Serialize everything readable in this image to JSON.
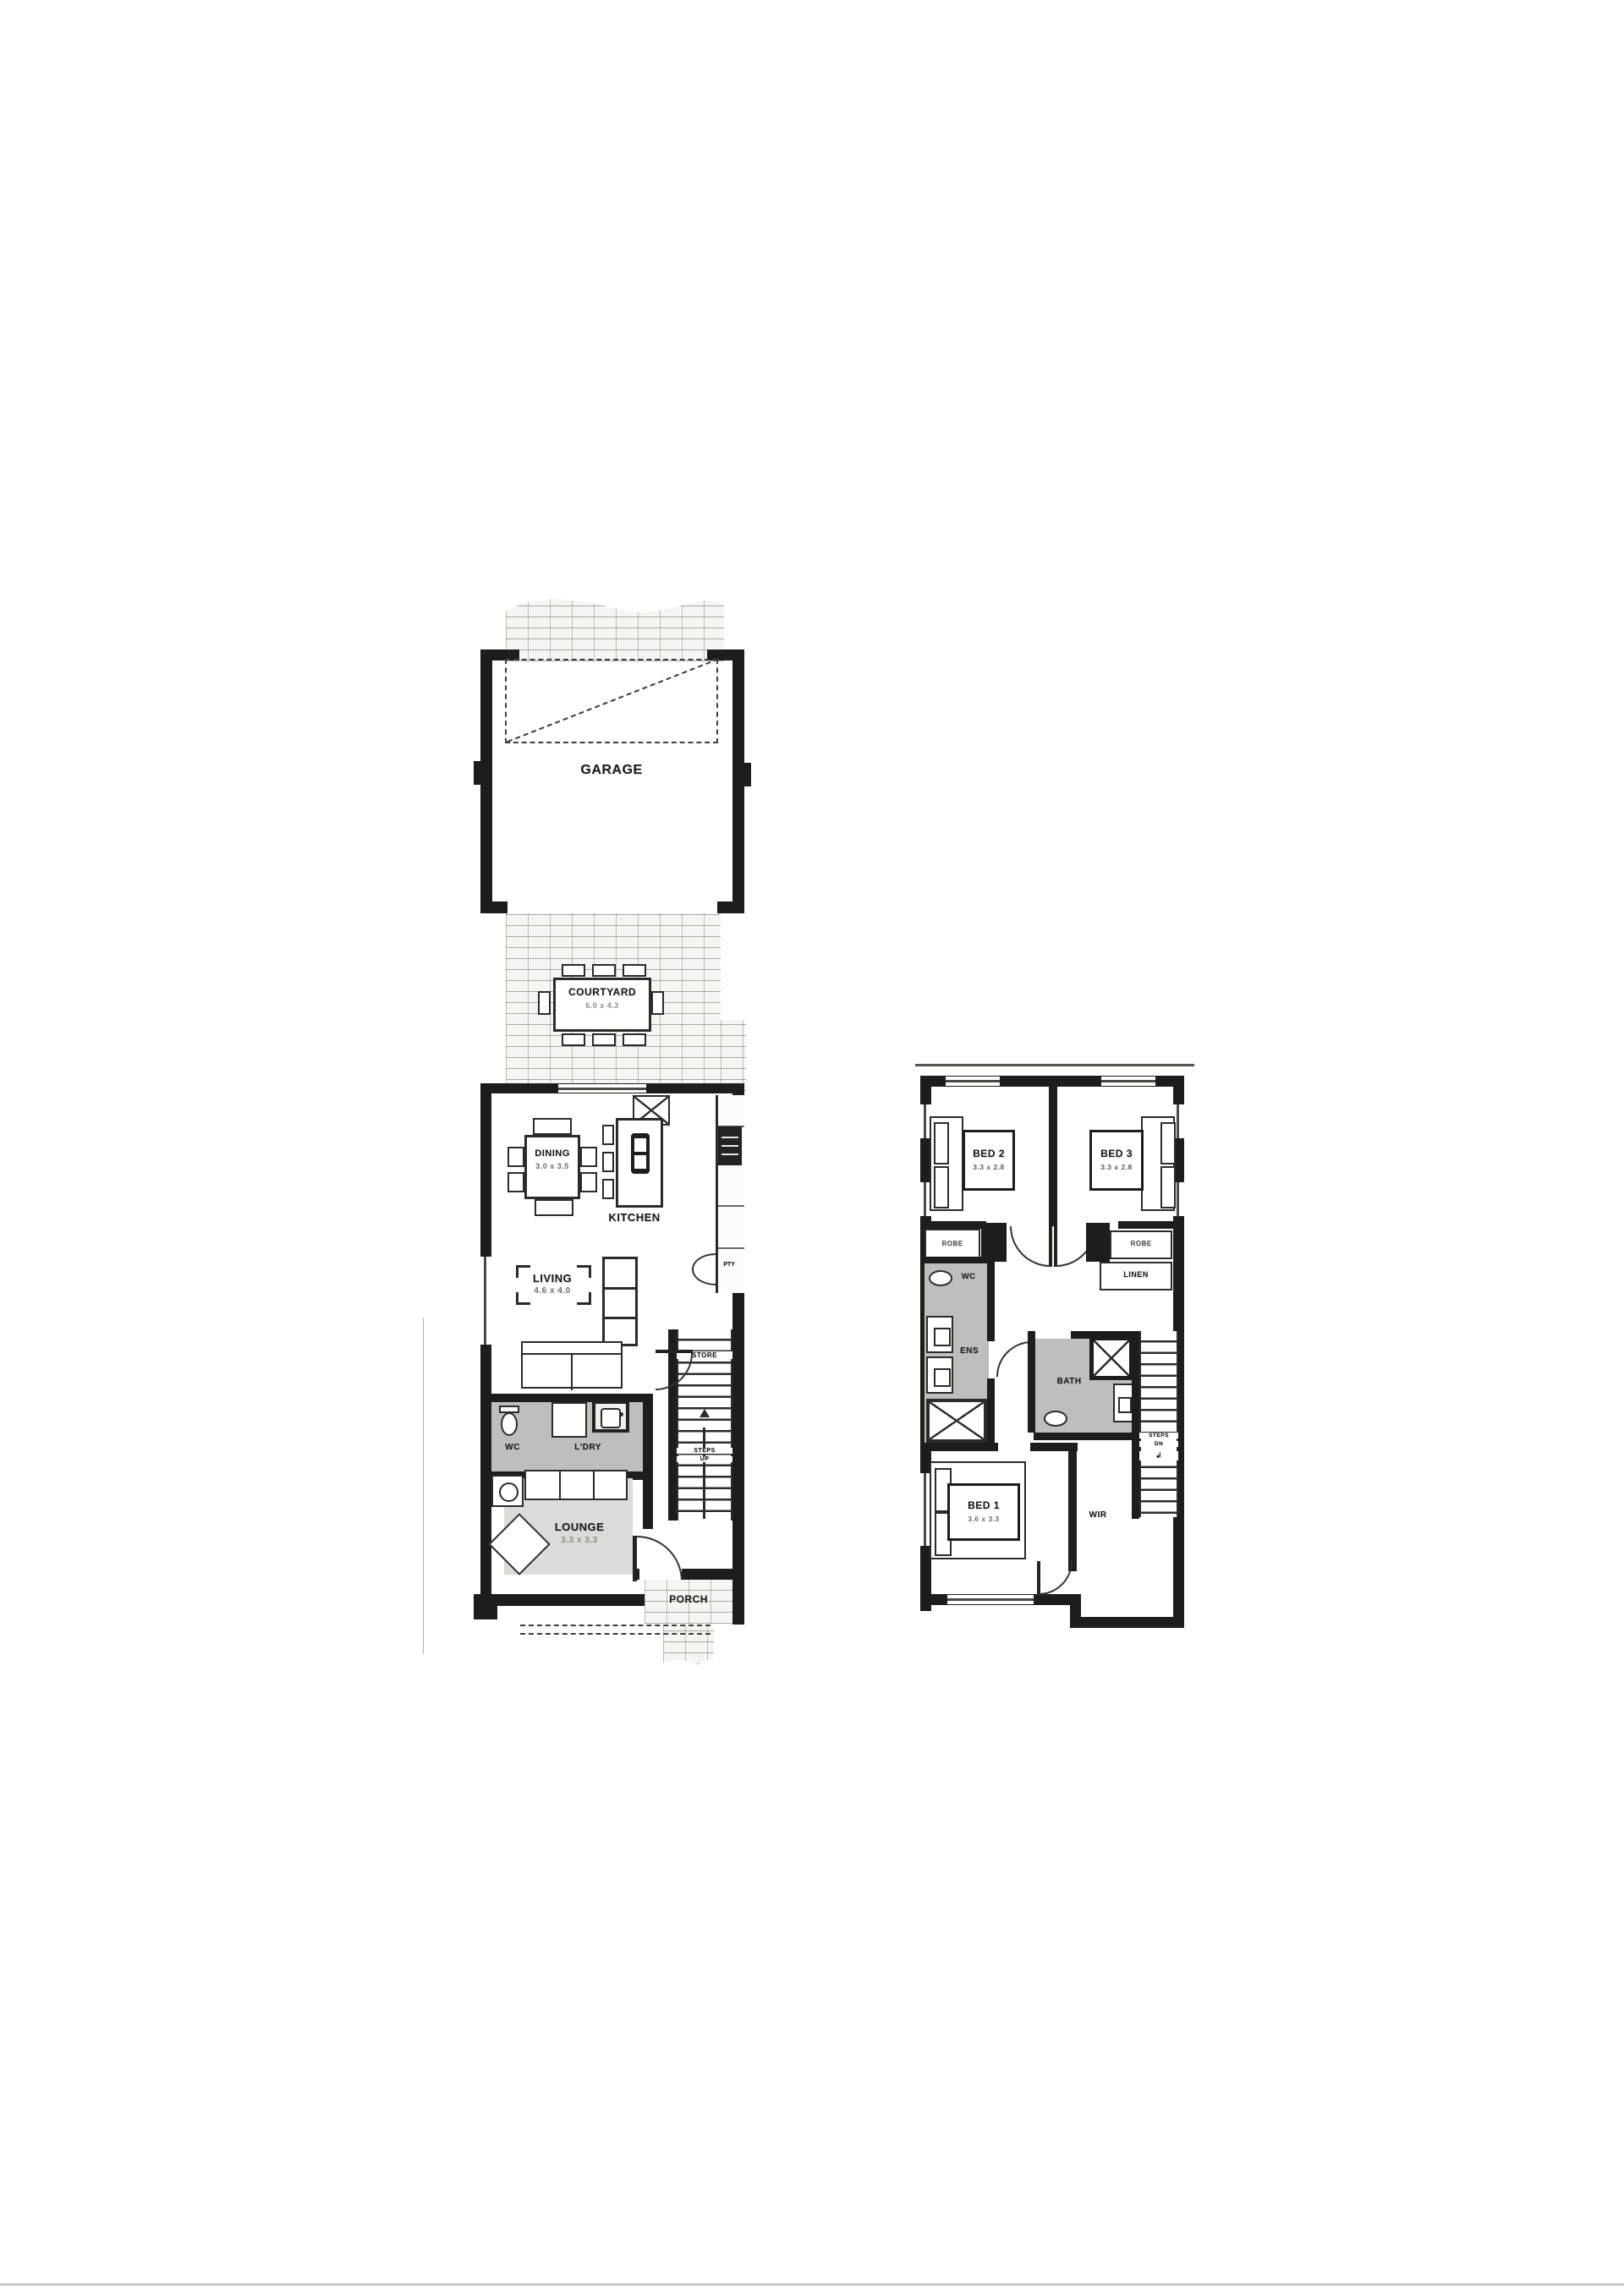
{
  "page": {
    "background": "#ffffff",
    "artifact_colors": {
      "bottom_edge": "#c9c9c6",
      "left_line": "#b5b5b2"
    }
  },
  "colors": {
    "wall": "#1d1d1b",
    "wet_area_shade": "#bfbebb",
    "rug_shade": "#dcdbd7",
    "brick_bg": "#f6f5f1",
    "brick_line": "#a09f99"
  },
  "ground_floor": {
    "garage": {
      "label": "GARAGE"
    },
    "courtyard": {
      "label": "COURTYARD",
      "dims": "6.0 x 4.3"
    },
    "dining": {
      "label": "DINING",
      "dims": "3.0 x 3.5"
    },
    "kitchen": {
      "label": "KITCHEN"
    },
    "pantry": {
      "label": "PTY"
    },
    "living": {
      "label": "LIVING",
      "dims": "4.6 x 4.0"
    },
    "store": {
      "label": "STORE"
    },
    "steps": {
      "line1": "STEPS",
      "line2": "UP"
    },
    "wc": {
      "label": "WC"
    },
    "laundry": {
      "label": "L'DRY"
    },
    "lounge": {
      "label": "LOUNGE",
      "dims": "3.3 x 3.3"
    },
    "porch": {
      "label": "PORCH"
    }
  },
  "first_floor": {
    "bed2": {
      "label": "BED 2",
      "dims": "3.3 x 2.8"
    },
    "bed3": {
      "label": "BED 3",
      "dims": "3.3 x 2.8"
    },
    "robe_left": {
      "label": "ROBE"
    },
    "robe_right": {
      "label": "ROBE"
    },
    "linen": {
      "label": "LINEN"
    },
    "wc": {
      "label": "WC"
    },
    "ens": {
      "label": "ENS"
    },
    "bath": {
      "label": "BATH"
    },
    "steps": {
      "line1": "STEPS",
      "line2": "DN"
    },
    "bed1": {
      "label": "BED 1",
      "dims": "3.6 x 3.3"
    },
    "wir": {
      "label": "WIR"
    }
  }
}
